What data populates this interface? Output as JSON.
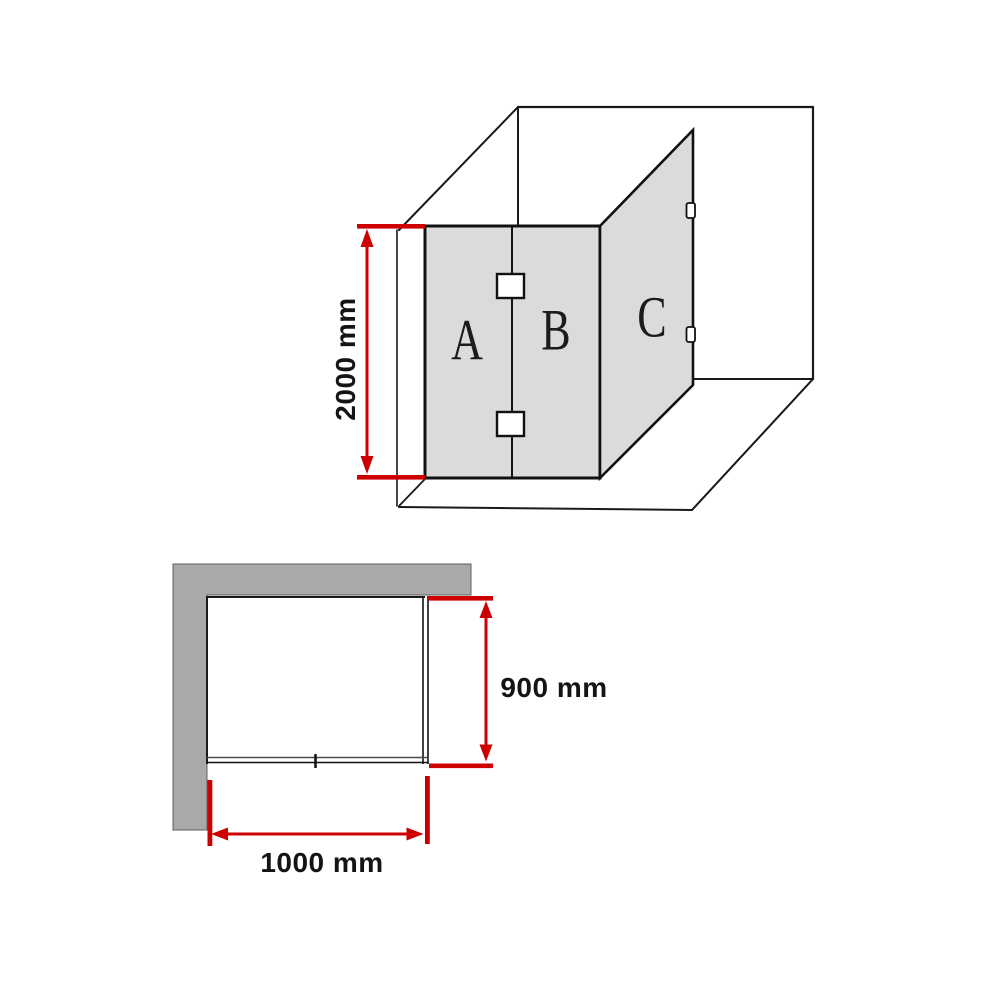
{
  "colors": {
    "dimension_red": "#cc0000",
    "panel_glass_gray": "#dbdbdb",
    "wall_gray": "#a9a9a9",
    "line_black": "#1a1a1a",
    "background": "#ffffff"
  },
  "perspective_view": {
    "panel_labels": [
      "A",
      "B",
      "C"
    ],
    "height_dimension_label": "2000 mm"
  },
  "plan_view": {
    "depth_dimension_label": "900 mm",
    "width_dimension_label": "1000 mm"
  }
}
